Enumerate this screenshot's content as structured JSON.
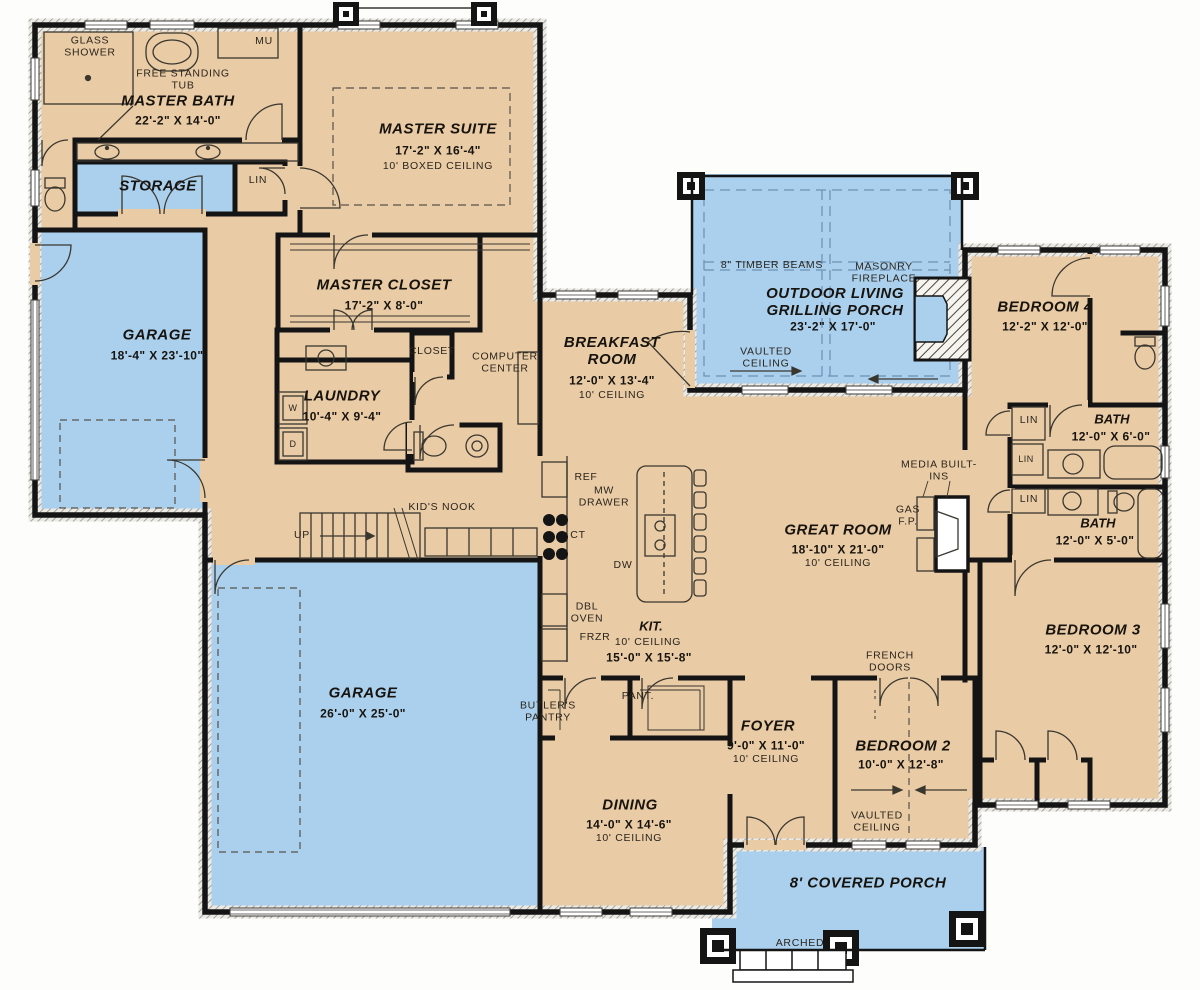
{
  "colors": {
    "floor": "#e9cba5",
    "porch_garage_blue": "#aad0ee",
    "wall": "#141414"
  },
  "rooms": {
    "master_bath": {
      "name": "MASTER BATH",
      "dims": "22'-2\" X 14'-0\""
    },
    "master_suite": {
      "name": "MASTER SUITE",
      "dims": "17'-2\" X 16'-4\"",
      "ceiling": "10' BOXED CEILING"
    },
    "storage": {
      "name": "STORAGE"
    },
    "garage_1": {
      "name": "GARAGE",
      "dims": "18'-4\" X 23'-10\""
    },
    "master_closet": {
      "name": "MASTER CLOSET",
      "dims": "17'-2\" X 8'-0\""
    },
    "laundry": {
      "name": "LAUNDRY",
      "dims": "10'-4\" X 9'-4\""
    },
    "breakfast_room": {
      "name": "BREAKFAST ROOM",
      "dims": "12'-0\" X 13'-4\"",
      "ceiling": "10' CEILING"
    },
    "outdoor_living": {
      "name": "OUTDOOR LIVING GRILLING PORCH",
      "dims": "23'-2\" X 17'-0\"",
      "ceiling": "VAULTED CEILING"
    },
    "bedroom_4": {
      "name": "BEDROOM 4",
      "dims": "12'-2\" X 12'-0\""
    },
    "bath_1": {
      "name": "BATH",
      "dims": "12'-0\" X 6'-0\""
    },
    "bath_2": {
      "name": "BATH",
      "dims": "12'-0\" X 5'-0\""
    },
    "great_room": {
      "name": "GREAT ROOM",
      "dims": "18'-10\" X 21'-0\"",
      "ceiling": "10' CEILING"
    },
    "kitchen": {
      "name": "KIT.",
      "dims": "15'-0\" X 15'-8\"",
      "ceiling": "10' CEILING"
    },
    "garage_2": {
      "name": "GARAGE",
      "dims": "26'-0\" X 25'-0\""
    },
    "foyer": {
      "name": "FOYER",
      "dims": "9'-0\" X 11'-0\"",
      "ceiling": "10' CEILING"
    },
    "bedroom_2": {
      "name": "BEDROOM 2",
      "dims": "10'-0\" X 12'-8\"",
      "ceiling": "VAULTED CEILING"
    },
    "dining": {
      "name": "DINING",
      "dims": "14'-0\" X 14'-6\"",
      "ceiling": "10' CEILING"
    },
    "bedroom_3": {
      "name": "BEDROOM 3",
      "dims": "12'-0\" X 12'-10\""
    },
    "covered_porch": {
      "name": "8' COVERED PORCH"
    }
  },
  "ann": {
    "glass_shower": "GLASS SHOWER",
    "free_standing_tub": "FREE STANDING TUB",
    "mu": "MU",
    "lin": "LIN",
    "closet": "CLOSET",
    "computer_center": "COMPUTER CENTER",
    "timber_beams": "8\" TIMBER BEAMS",
    "masonry_fireplace": "MASONRY FIREPLACE",
    "media_built_ins": "MEDIA BUILT-INS",
    "gas_fp": "GAS F.P.",
    "kids_nook": "KID'S NOOK",
    "up": "UP",
    "ref": "REF",
    "mw_drawer": "MW DRAWER",
    "ct": "CT",
    "dw": "DW",
    "dbl_oven": "DBL OVEN",
    "frzr": "FRZR",
    "butlers_pantry": "BUTLER'S PANTRY",
    "pant": "PANT.",
    "french_doors": "FRENCH DOORS",
    "arched": "ARCHED",
    "washer": "W",
    "dryer": "D"
  }
}
